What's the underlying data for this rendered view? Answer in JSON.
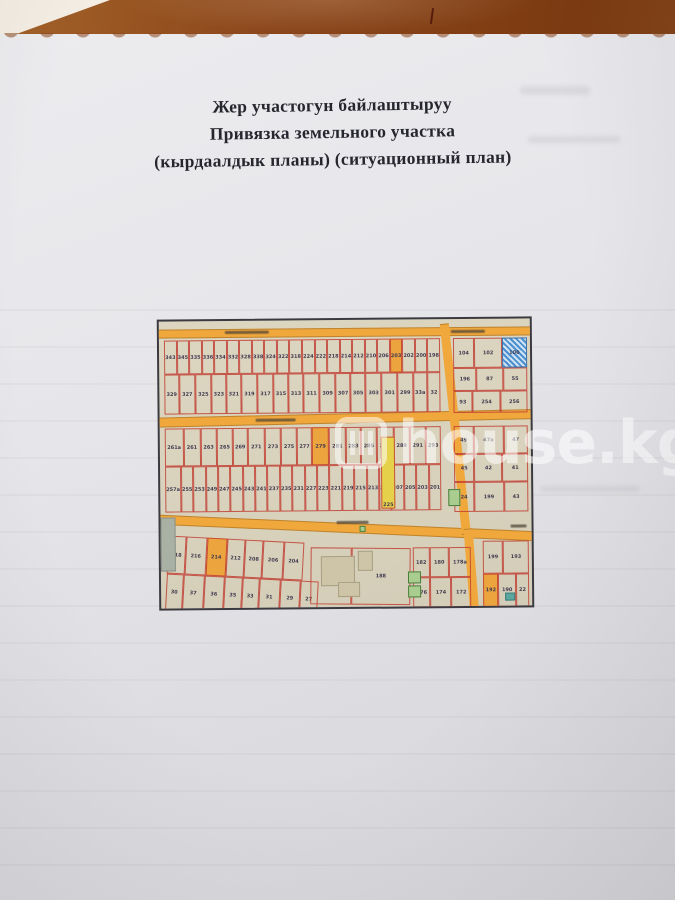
{
  "document": {
    "title_lines": [
      "Жер участогун байлаштыруу",
      "Привязка земельного участка",
      "(кырдаалдык планы) (ситуационный план)"
    ]
  },
  "watermark": {
    "icon": "house-icon",
    "text": "house.kg"
  },
  "colors": {
    "table_brown": "#8a451a",
    "paper": "#e6e6ea",
    "map_background": "#d8d2bd",
    "road_orange": "#f0a83d",
    "parcel_line_red": "#c13e32",
    "highlight_yellow": "#e6d14b",
    "highlight_orange": "#eca43e",
    "water_blue": "#4a8fd0",
    "building_green": "#a8cd8f"
  },
  "map": {
    "type": "cadastral-situational-plan",
    "roads": [
      {
        "x": -2,
        "y": 8,
        "w": 380,
        "h": 9,
        "r": 0
      },
      {
        "x": -2,
        "y": 96,
        "w": 380,
        "h": 10,
        "r": -0.8
      },
      {
        "x": -4,
        "y": 193,
        "w": 382,
        "h": 10,
        "r": 3.0
      },
      {
        "x": 281,
        "y": 5,
        "w": 9,
        "h": 212,
        "r": -5.5
      },
      {
        "x": 303,
        "y": 210,
        "w": 9,
        "h": 84,
        "r": -4
      }
    ],
    "street_label_marks": [
      {
        "x": 66,
        "y": 10,
        "w": 44
      },
      {
        "x": 292,
        "y": 11,
        "w": 34
      },
      {
        "x": 96,
        "y": 98,
        "w": 40
      },
      {
        "x": 176,
        "y": 201,
        "w": 32
      },
      {
        "x": 350,
        "y": 206,
        "w": 16
      }
    ],
    "blocks": [
      {
        "x": 5,
        "y": 19,
        "w": 276,
        "h": 34,
        "parcels": [
          "343",
          "345",
          "335",
          "336",
          "334",
          "332",
          "328",
          "338",
          "324",
          "322",
          "318",
          "224",
          "222",
          "218",
          "214",
          "212",
          "210",
          "206",
          {
            "n": "203",
            "f": "o"
          },
          "202",
          "200",
          "198"
        ]
      },
      {
        "x": 5,
        "y": 53,
        "w": 276,
        "h": 40,
        "parcels": [
          "329",
          "327",
          "325",
          "323",
          "321",
          "319",
          "317",
          "315",
          "313",
          "311",
          "309",
          "307",
          "305",
          "303",
          "301",
          "299",
          "33a",
          "32"
        ]
      },
      {
        "x": 294,
        "y": 19,
        "w": 74,
        "h": 30,
        "parcels": [
          "104",
          "102",
          {
            "n": "100",
            "f": "b"
          }
        ]
      },
      {
        "x": 294,
        "y": 49,
        "w": 74,
        "h": 23,
        "parcels": [
          "196",
          "87",
          "55"
        ]
      },
      {
        "x": 294,
        "y": 72,
        "w": 74,
        "h": 22,
        "parcels": [
          "93",
          "254",
          "256"
        ]
      },
      {
        "x": 5,
        "y": 107,
        "w": 276,
        "h": 38,
        "parcels": [
          "261a",
          "261",
          "263",
          "265",
          "269",
          "271",
          "273",
          "275",
          "277",
          {
            "n": "279",
            "f": "o"
          },
          "281",
          "283",
          "285",
          "287",
          "289",
          "291",
          "293"
        ]
      },
      {
        "x": 294,
        "y": 107,
        "w": 74,
        "h": 28,
        "parcels": [
          "49",
          "47a",
          "47"
        ]
      },
      {
        "x": 294,
        "y": 135,
        "w": 74,
        "h": 28,
        "parcels": [
          "45",
          "42",
          "41"
        ]
      },
      {
        "x": 294,
        "y": 163,
        "w": 74,
        "h": 30,
        "parcels": [
          "24",
          "199",
          "43"
        ]
      },
      {
        "x": 5,
        "y": 145,
        "w": 276,
        "h": 46,
        "parcels": [
          "257a",
          "255",
          "253",
          "249",
          "247",
          "245",
          "243",
          "241",
          "237",
          "235",
          "231",
          "227",
          "223",
          "221",
          "219",
          "215",
          "213",
          "210",
          "207",
          "205",
          "203",
          "201"
        ]
      },
      {
        "x": 8,
        "y": 214,
        "w": 136,
        "h": 38,
        "r": 3.5,
        "parcels": [
          "218",
          "216",
          {
            "n": "214",
            "f": "o"
          },
          "212",
          "208",
          "206",
          "204"
        ]
      },
      {
        "x": 6,
        "y": 252,
        "w": 152,
        "h": 36,
        "r": 3.5,
        "parcels": [
          "30",
          "37",
          "36",
          "35",
          "33",
          "31",
          "29",
          "27"
        ]
      },
      {
        "x": 150,
        "y": 227,
        "w": 100,
        "h": 57,
        "r": 1,
        "parcels": [
          "200",
          "188"
        ]
      },
      {
        "x": 252,
        "y": 228,
        "w": 58,
        "h": 30,
        "parcels": [
          "182",
          "180",
          "178a"
        ]
      },
      {
        "x": 252,
        "y": 258,
        "w": 58,
        "h": 30,
        "parcels": [
          "176",
          "174",
          "172"
        ]
      },
      {
        "x": 322,
        "y": 222,
        "w": 46,
        "h": 33,
        "parcels": [
          "199",
          "193"
        ]
      },
      {
        "x": 322,
        "y": 255,
        "w": 46,
        "h": 33,
        "parcels": [
          {
            "n": "192",
            "f": "o"
          },
          "190",
          "22"
        ]
      }
    ],
    "specials": [
      {
        "x": 221,
        "y": 117,
        "w": 14,
        "h": 72,
        "f": "y",
        "n": "225"
      },
      {
        "x": 0,
        "y": 196,
        "w": 15,
        "h": 54,
        "f": "gr"
      },
      {
        "x": 160,
        "y": 236,
        "w": 34,
        "h": 30,
        "f": "tan"
      },
      {
        "x": 197,
        "y": 231,
        "w": 15,
        "h": 20,
        "f": "tan"
      },
      {
        "x": 177,
        "y": 262,
        "w": 22,
        "h": 15,
        "f": "tan"
      },
      {
        "x": 288,
        "y": 170,
        "w": 12,
        "h": 17,
        "f": "g"
      },
      {
        "x": 247,
        "y": 252,
        "w": 13,
        "h": 12,
        "f": "g"
      },
      {
        "x": 247,
        "y": 266,
        "w": 13,
        "h": 12,
        "f": "g"
      },
      {
        "x": 199,
        "y": 206,
        "w": 6,
        "h": 6,
        "f": "g"
      },
      {
        "x": 344,
        "y": 274,
        "w": 10,
        "h": 8,
        "f": "t"
      }
    ]
  }
}
